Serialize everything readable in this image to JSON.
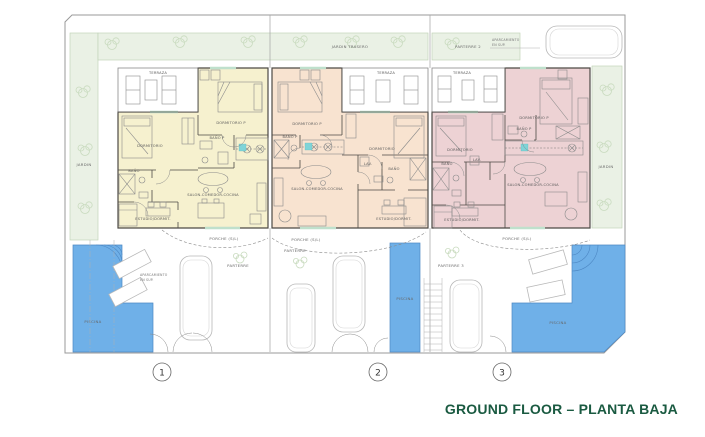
{
  "title": "GROUND FLOOR – PLANTA BAJA",
  "colors": {
    "unit1_fill": "#f6f1cf",
    "unit2_fill": "#f8e3d0",
    "unit3_fill": "#edd2d4",
    "garden_fill": "#eaf1e5",
    "garden_stroke": "#c2d4ba",
    "pool_fill": "#6fb0e8",
    "pool_stroke": "#4d88c4",
    "wall": "#4d4a45",
    "furniture": "#8b8b8b",
    "accent_teal": "#7fd4d8",
    "window_green": "#bfe0cc",
    "title_green": "#1a5a41",
    "label_gray": "#5a5a5a"
  },
  "site": {
    "jardin_left": "JARDIN",
    "jardin_right": "JARDIN",
    "jardin_trasero": "JARDIN TRASERO",
    "parterre_2": "PARTERRE 2",
    "parterre_3": "PARTERRE 3",
    "parterre": "PARTERRE",
    "porche": "PORCHE (S/L)",
    "piscina": "PISCINA",
    "aparcamiento_line1": "APARCAMIENTO",
    "aparcamiento_line2": "EN SUP."
  },
  "rooms": {
    "terraza": "TERRAZA",
    "dormitorio_p": "DORMITORIO P",
    "bano_p": "BAÑO P",
    "dormitorio": "DORMITORIO",
    "bano": "BAÑO",
    "lav": "LAV.",
    "salon": "SALON-COMEDOR-COCINA",
    "estudio": "ESTUDIO/DORMIT."
  },
  "units": [
    {
      "number": "1"
    },
    {
      "number": "2"
    },
    {
      "number": "3"
    }
  ]
}
